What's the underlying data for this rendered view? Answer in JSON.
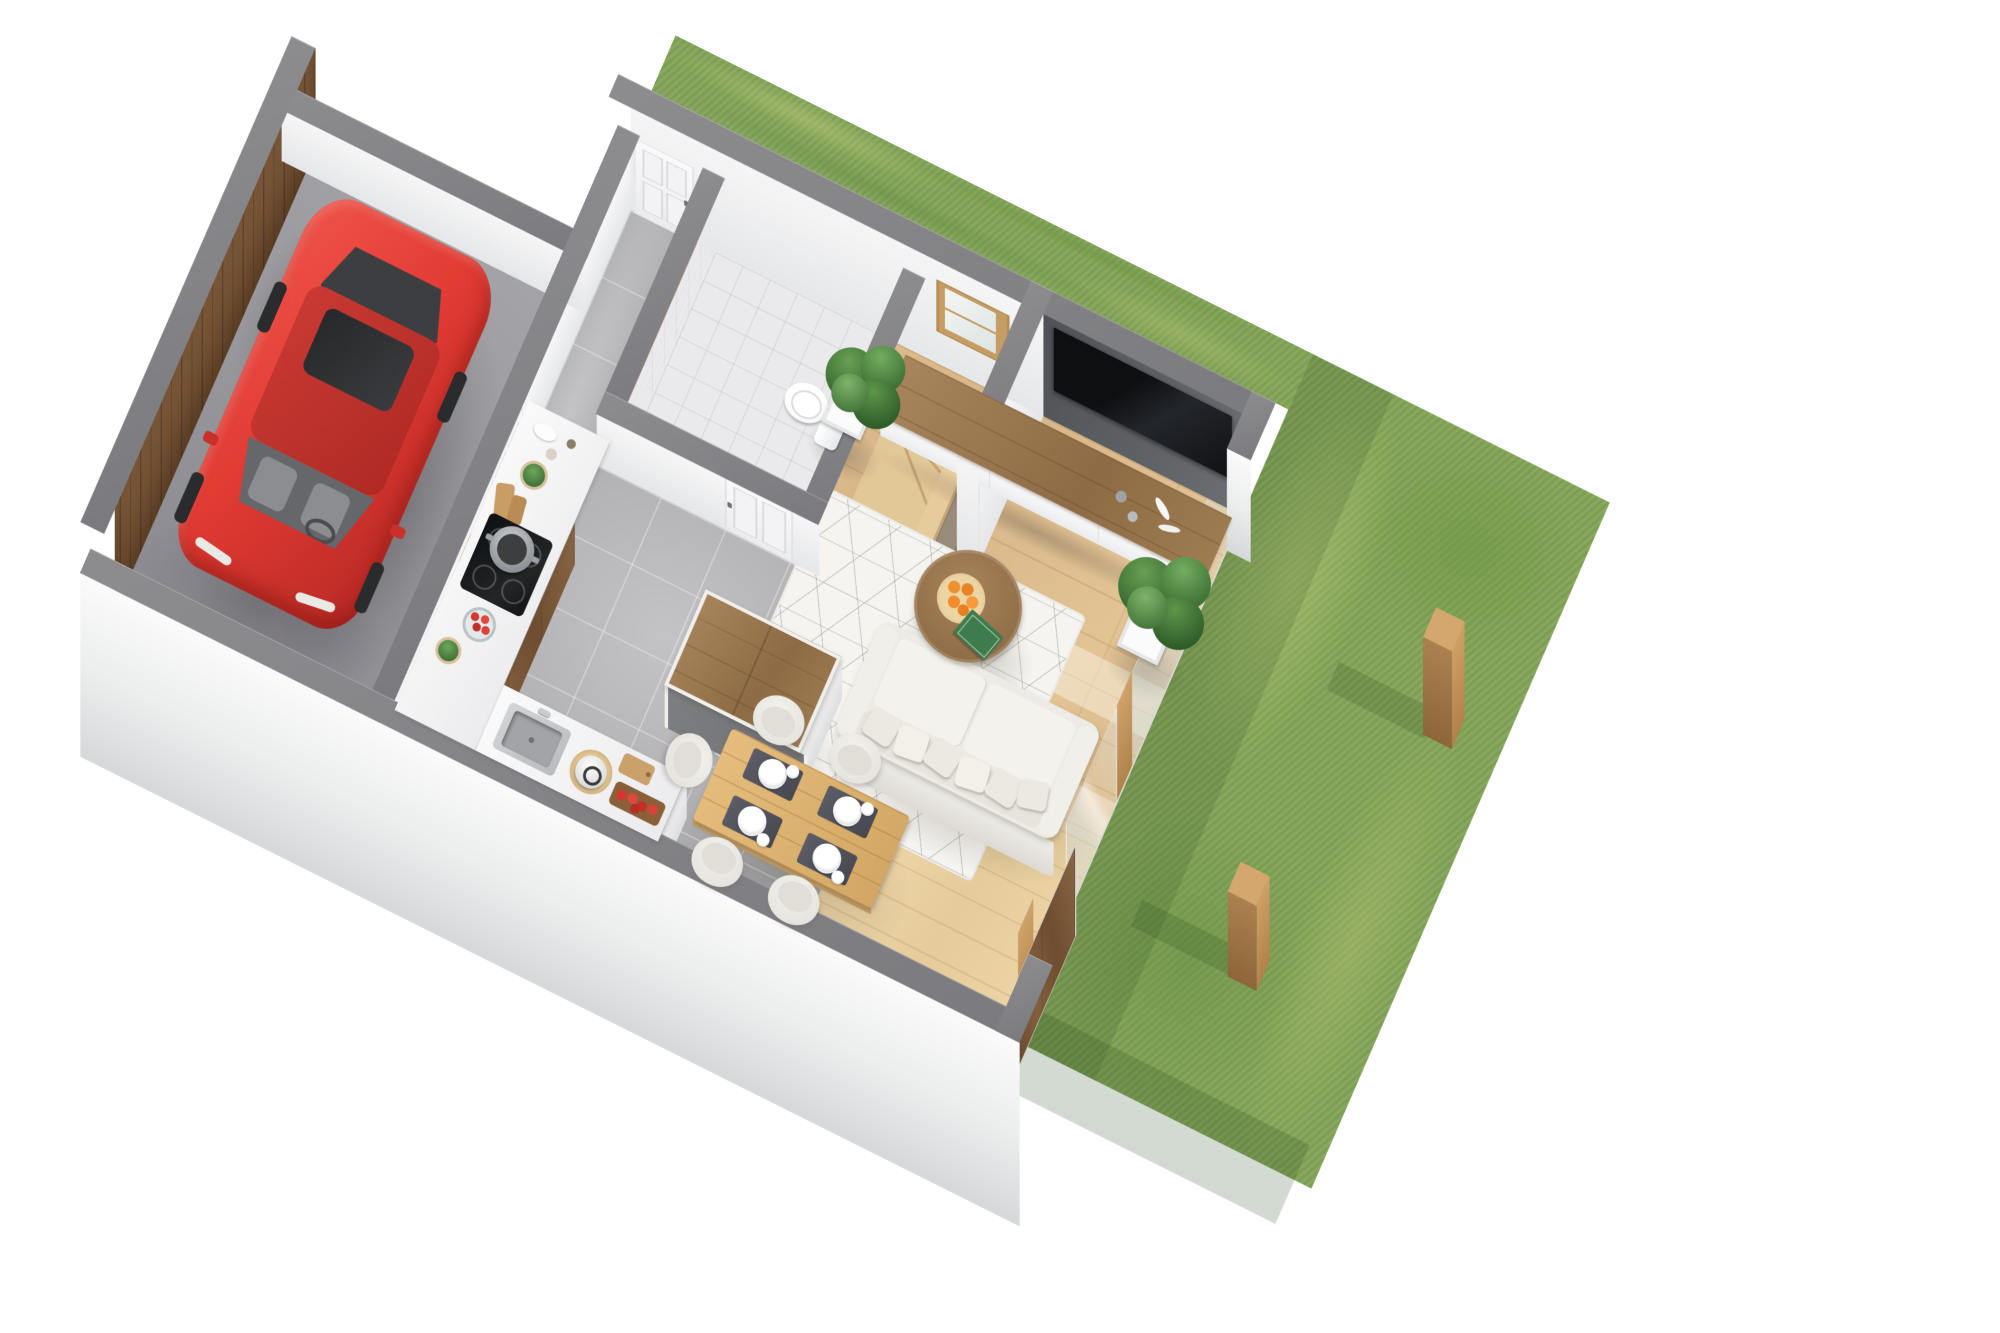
{
  "scene": {
    "title": "3D axonometric floor-plan render — ground floor with garage, open-plan living area and garden",
    "type": "architectural 3D floor plan",
    "background_color": "#ffffff",
    "camera": "top-down axonometric view, plan rotated about 26 degrees",
    "palette": {
      "wall_top_grey": "#828286",
      "exterior_wall_white": "#e9eaeb",
      "tv_wall_charcoal": "#5a5b5e",
      "oak_floor": "#dcbd92",
      "terrace_plank": "#eed6a8",
      "grey_tile": "#b7b7b9",
      "concrete": "#96959a",
      "walnut_wood": "#774f31",
      "lawn_green": "#83a457",
      "car_red": "#e23b33",
      "sofa_ivory": "#edebe5"
    },
    "rooms": [
      {
        "name": "garage",
        "floor": "dark concrete",
        "objects": [
          "red hatchback car with sunroof",
          "dark wood garage door wall"
        ]
      },
      {
        "name": "entry-hall",
        "floor": "grey tile",
        "objects": [
          "white front door",
          "white interior door to hall",
          "picture frame"
        ]
      },
      {
        "name": "bathroom",
        "floor": "light tile",
        "objects": [
          "toilet",
          "white panel door",
          "white tiled walls"
        ]
      },
      {
        "name": "staircase",
        "objects": [
          "L-shaped oak staircase",
          "winder steps",
          "wood framed window"
        ]
      },
      {
        "name": "kitchen",
        "floor": "grey tile",
        "objects": [
          "L-shaped counter with white top and walnut fronts",
          "black cooktop",
          "steel pot",
          "bowl of tomatoes",
          "steel sink",
          "kettle on mat",
          "cutting boards",
          "board with apples",
          "herb pots",
          "walnut kitchen island with grey side"
        ]
      },
      {
        "name": "dining-area",
        "floor": "light plank wood",
        "objects": [
          "oak dining table",
          "4 dark placemats with white plates and bowls",
          "5 white shell chairs",
          "walnut sliding terrace door"
        ]
      },
      {
        "name": "living-room",
        "floor": "oak parquet",
        "objects": [
          "charcoal TV wall",
          "large wall-mounted black TV",
          "long media cabinet white with walnut top",
          "candle decor on cabinet",
          "white geometric rug",
          "ivory sofa with pillows",
          "round walnut coffee table",
          "plate of oranges",
          "green book",
          "potted plant near stairs",
          "potted plant near glass wall",
          "glass sliding wall with wood mullions"
        ]
      },
      {
        "name": "garden",
        "objects": [
          "large lawn",
          "grass strip behind north wall",
          "two wooden fence posts",
          "cast shadows on grass"
        ]
      }
    ],
    "counts": {
      "chairs": 5,
      "place_settings": 4,
      "fence_posts": 2,
      "plants_large": 2,
      "doors_white": 3
    }
  }
}
